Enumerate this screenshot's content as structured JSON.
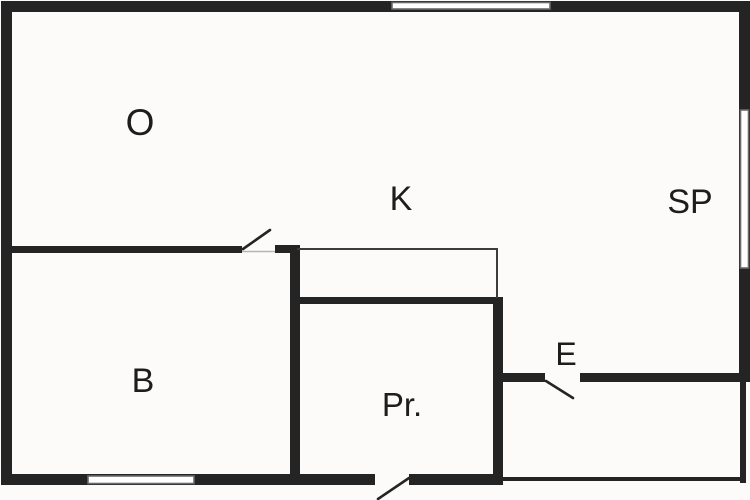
{
  "diagram": {
    "kind": "floor-plan"
  },
  "colors": {
    "background": "#fcfbf9",
    "wall": "#242424",
    "thin_line": "#3c3c3c",
    "window_outline": "#6a6a6a",
    "threshold": "#b8b5b0",
    "label": "#1d1d1d"
  },
  "rooms": [
    {
      "label": "O"
    },
    {
      "label": "K"
    },
    {
      "label": "SP"
    },
    {
      "label": "B"
    },
    {
      "label": "Pr."
    },
    {
      "label": "E"
    }
  ]
}
